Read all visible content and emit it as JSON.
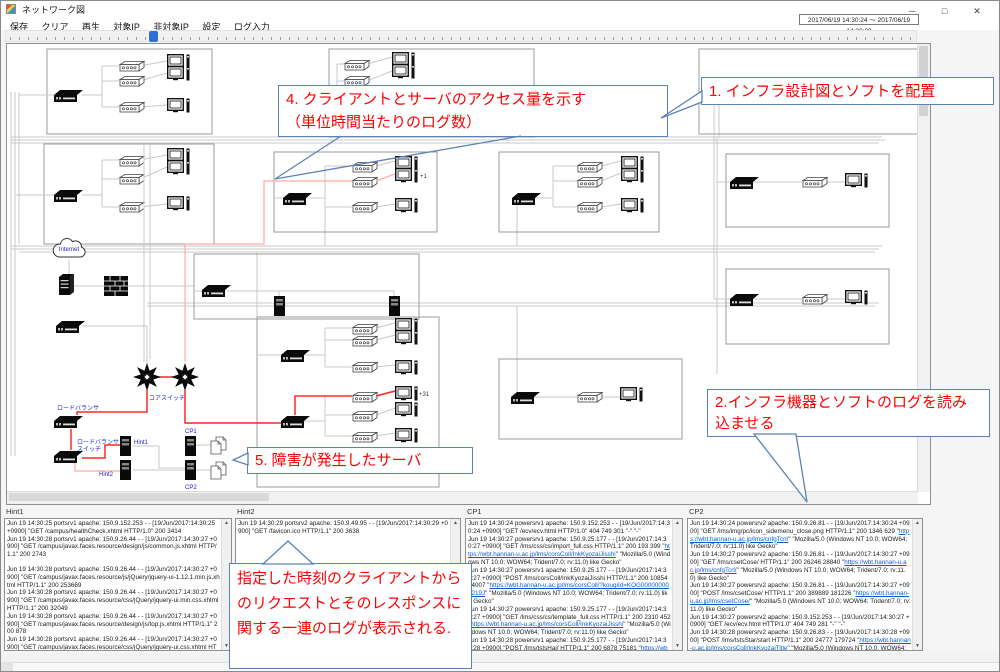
{
  "window": {
    "title": "ネットワーク図",
    "controls": {
      "minimize": "─",
      "maximize": "□",
      "close": "✕"
    },
    "date_range": "2017/06/19 14:30:24 ～ 2017/06/19 14:30:29"
  },
  "menu": {
    "items": [
      "保存",
      "クリア",
      "再生",
      "対象IP",
      "非対象IP",
      "設定",
      "ログ入力"
    ]
  },
  "callouts": {
    "c1": "1. インフラ設計図とソフトを配置",
    "c2": "2.インフラ機器とソフトのログを読み込ませる",
    "c4_line1": "4. クライアントとサーバのアクセス量を示す",
    "c4_line2": "（単位時間当たりのログ数）",
    "c5": "5. 障害が発生したサーバ",
    "c_bottom": "指定した時刻のクライアントからのリクエストとそのレスポンスに関する一連のログが表示される."
  },
  "diagram": {
    "labels": {
      "internet": "Internet",
      "core_switch": "コアスイッチ",
      "load_balancer": "ロードバランサ",
      "lb_switch_line1": "ロードバランサ",
      "lb_switch_line2": "スイッチ",
      "hint1": "Hint1",
      "hint2": "Hint2",
      "cp1": "CP1",
      "cp2": "CP2",
      "plus1": "+1",
      "plus31": "+31"
    }
  },
  "log_panels": [
    {
      "title": "Hint1",
      "lines": [
        [
          {
            "t": "Jun 19 14:30:25 portsrv1 apache: 150.9.152.253 - - [19/Jun/2017:14:30:25 +0900] \"GET /campus/healthCheck.xhtml HTTP/1.0\" 200 3414"
          }
        ],
        [
          {
            "t": "Jun 19 14:30:28 portsrv1 apache: 150.9.26.44 - - [19/Jun/2017:14:30:27 +0900] \"GET /campus/javax.faces.resource/design/js/common.js.xhtml HTTP/1.1\" 200 2743"
          }
        ],
        [],
        [
          {
            "t": "Jun 19 14:30:28 portsrv1 apache: 150.9.26.44 - - [19/Jun/2017:14:30:27 +0900] \"GET /campus/javax.faces.resource/js/jQuery/jquery-ui-1.12.1.min.js.xhtml HTTP/1.1\" 200 253669"
          }
        ],
        [
          {
            "t": "Jun 19 14:30:28 portsrv1 apache: 150.9.26.44 - - [19/Jun/2017:14:30:27 +0900] \"GET /campus/javax.faces.resource/css/jQuery/jquery-ui.min.css.xhtml HTTP/1.1\" 200 32049"
          }
        ],
        [
          {
            "t": "Jun 19 14:30:28 portsrv1 apache: 150.9.26.44 - - [19/Jun/2017:14:30:27 +0900] \"GET /campus/javax.faces.resource/design/js/top.js.xhtml HTTP/1.1\" 200 878"
          }
        ],
        [
          {
            "t": "Jun 19 14:30:28 portsrv1 apache: 150.9.26.44 - - [19/Jun/2017:14:30:27 +0900] \"GET /campus/javax.faces.resource/css/jQuery/jquery-ui.css.xhtml HTTP/1.1\" 200 37284"
          }
        ],
        [],
        [
          {
            "t": "Jun 19 14:30:27 portsrv1 apache: 150.9.26.44 - - [19/Jun/2017:14:30:27 +0900] \"GET /campus/javax.faces.resource/js/jQuery/jquery-1.12.1.min.js.xhtml HTTP/1.1\" 200"
          }
        ]
      ]
    },
    {
      "title": "Hint2",
      "lines": [
        [
          {
            "t": "Jun 19 14:30:29 portsrv2 apache: 150.9.49.95 - - [19/Jun/2017:14:30:29 +0900] \"GET /favicon.ico HTTP/1.1\" 200 3638"
          }
        ]
      ]
    },
    {
      "title": "CP1",
      "lines": [
        [
          {
            "t": "Jun 19 14:30:24 powersrv1 apache: 150.9.152.253 - - [19/Jun/2017:14:30:24 +0900] \"GET /ecv/ecv.html HTTP/1.0\" 404 749 301 \"-\" \"-\""
          }
        ],
        [
          {
            "t": "Jun 19 14:30:27 powersrv1 apache: 150.9.25.177 - - [19/Jun/2017:14:30:27 +0900] \"GET /lms/css/cs/import_full.css HTTP/1.1\" 200 193 399 \""
          },
          {
            "t": "https://wbt.hannan-u.ac.jp/lms/corsColl/InkKyozaiJisshi",
            "link": true
          },
          {
            "t": "\" \"Mozilla/5.0 (Windows NT 10.0; WOW64; Trident/7.0; rv:11.0) like Gecko\""
          }
        ],
        [
          {
            "t": "Jun 19 14:30:27 powersrv1 apache: 150.9.25.177 - - [19/Jun/2017:14:30:27 +0900] \"POST /lms/corsColl/InkKyozaiJisshi HTTP/1.1\" 200 10854 24007 \""
          },
          {
            "t": "https://wbt.hannan-u.ac.jp/lms/corsColl/?kougiId=KOG000000001219J",
            "link": true
          },
          {
            "t": "\" \"Mozilla/5.0 (Windows NT 10.0; WOW64; Trident/7.0; rv:11.0) like Gecko\""
          }
        ],
        [
          {
            "t": "Jun 19 14:30:27 powersrv1 apache: 150.9.25.177 - - [19/Jun/2017:14:30:27 +0900] \"GET /lms/css/cs/template_full.css HTTP/1.1\" 200 2310 452 \""
          },
          {
            "t": "https://wbt.hannan-u.ac.jp/lms/corsColl/InkKyozaiJisshi",
            "link": true
          },
          {
            "t": "\" \"Mozilla/5.0 (Windows NT 10.0; WOW64; Trident/7.0; rv:11.0) like Gecko\""
          }
        ],
        [
          {
            "t": "Jun 19 14:30:28 powersrv1 apache: 150.9.25.177 - - [19/Jun/2017:14:30:28 +0900] \"POST /lms/tstsHai/ HTTP/1.1\" 200 6878 75181 \""
          },
          {
            "t": "https://wbt.hannan-u.ac.jp/lms/corsColl/InkKyozaiJisshi",
            "link": true
          },
          {
            "t": "\" \"Mozilla/5.0 (Windows NT 10.0; WOW64; Trident/7.0; rv:11.0) like Gecko\""
          }
        ]
      ]
    },
    {
      "title": "CP2",
      "lines": [
        [
          {
            "t": "Jun 19 14:30:24 powersrv2 apache: 150.9.26.81 - - [19/Jun/2017:14:30:24 +0900] \"GET /lms/img/pc/icon_sidemenu_close.png HTTP/1.1\" 200 1346 629 \""
          },
          {
            "t": "https://wbt.hannan-u.ac.jp/lms/cnfgTcrl/",
            "link": true
          },
          {
            "t": "\" \"Mozilla/5.0 (Windows NT 10.0; WOW64; Trident/7.0; rv:11.0) like Gecko\""
          }
        ],
        [
          {
            "t": "Jun 19 14:30:27 powersrv2 apache: 150.9.26.81 - - [19/Jun/2017:14:30:27 +0900] \"GET /lms/csetCose/ HTTP/1.1\" 200 26246 28840 \""
          },
          {
            "t": "https://wbt.hannan-u.ac.jp/lms/cnfgTcrl/",
            "link": true
          },
          {
            "t": "\" \"Mozilla/5.0 (Windows NT 10.0; WOW64; Trident/7.0; rv:11.0) like Gecko\""
          }
        ],
        [
          {
            "t": "Jun 19 14:30:27 powersrv2 apache: 150.9.26.81 - - [19/Jun/2017:14:30:27 +0900] \"POST /lms/csetCose/ HTTP/1.1\" 200 389889 181226 \""
          },
          {
            "t": "https://wbt.hannan-u.ac.jp/lms/csetCose/",
            "link": true
          },
          {
            "t": "\" \"Mozilla/5.0 (Windows NT 10.0; WOW64; Trident/7.0; rv:11.0) like Gecko\""
          }
        ],
        [
          {
            "t": "Jun 19 14:30:27 powersrv2 apache: 150.9.152.253 - - [19/Jun/2017:14:30:27 +0900] \"GET /ecv/ecv.html HTTP/1.0\" 404 749 281 \"-\" \"-\""
          }
        ],
        [
          {
            "t": "Jun 19 14:30:28 powersrv2 apache: 150.9.26.83 - - [19/Jun/2017:14:30:28 +0900] \"POST /lms/tstsStar/start HTTP/1.1\" 200 24777 179724 \""
          },
          {
            "t": "https://wbt.hannan-u.ac.jp/lms/corsColl/InkKyozaiTitle",
            "link": true
          },
          {
            "t": "\" \"Mozilla/5.0 (Windows NT 10.0; WOW64; Trident/7.0; rv:11.0) like Gecko\""
          }
        ]
      ]
    }
  ],
  "colors": {
    "annotation_red": "#ff0000",
    "callout_border": "#5b83b5",
    "link_blue": "#0b5bd3",
    "slider_thumb": "#2d6fd4",
    "highlight_path_red": "#ff2626"
  }
}
